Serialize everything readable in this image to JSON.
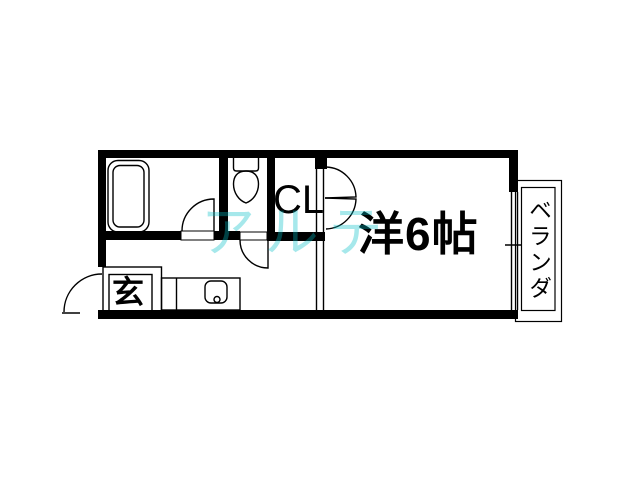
{
  "floorplan": {
    "labels": {
      "main_room": "洋6帖",
      "closet": "CL",
      "entrance": "玄",
      "balcony": "ベランダ"
    },
    "watermark": {
      "text": "アルテ",
      "color": "rgba(0,189,199,0.35)"
    },
    "colors": {
      "background": "#ffffff",
      "walls": "#000000",
      "lines": "#000000"
    },
    "fixtures": [
      {
        "name": "bathtub"
      },
      {
        "name": "toilet"
      },
      {
        "name": "kitchen-sink-counter"
      },
      {
        "name": "entrance-step-box"
      },
      {
        "name": "entrance-door"
      },
      {
        "name": "bathroom-door"
      },
      {
        "name": "toilet-door"
      },
      {
        "name": "closet-double-door"
      },
      {
        "name": "balcony-window"
      },
      {
        "name": "balcony-outline"
      }
    ]
  }
}
